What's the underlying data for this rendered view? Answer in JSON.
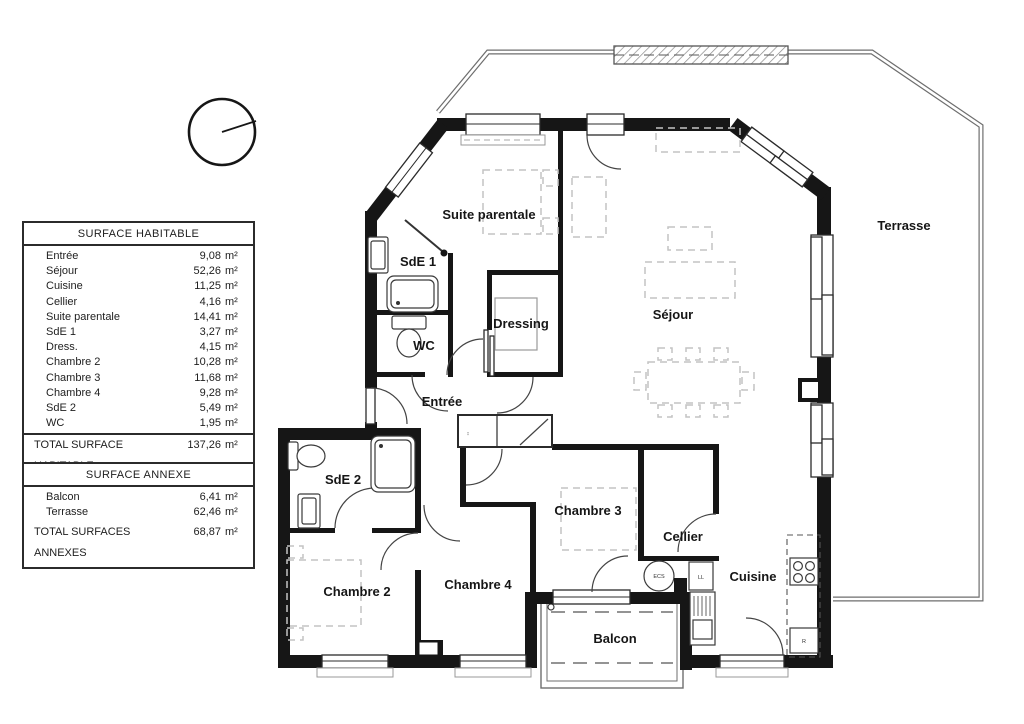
{
  "plan": {
    "rooms": {
      "suite_parentale": "Suite parentale",
      "sde1": "SdE 1",
      "wc": "WC",
      "dressing": "Dressing",
      "sejour": "Séjour",
      "entree": "Entrée",
      "sde2": "SdE 2",
      "chambre2": "Chambre 2",
      "chambre3": "Chambre 3",
      "chambre4": "Chambre 4",
      "cellier": "Cellier",
      "cuisine": "Cuisine",
      "balcon": "Balcon",
      "terrasse": "Terrasse"
    },
    "appliances": {
      "ecs": "ECS",
      "ll": "LL",
      "r": "R"
    }
  },
  "tables": {
    "habitable": {
      "title": "SURFACE HABITABLE",
      "rows": [
        {
          "label": "Entrée",
          "value": "9,08",
          "unit": "m²"
        },
        {
          "label": "Séjour",
          "value": "52,26",
          "unit": "m²"
        },
        {
          "label": "Cuisine",
          "value": "11,25",
          "unit": "m²"
        },
        {
          "label": "Cellier",
          "value": "4,16",
          "unit": "m²"
        },
        {
          "label": "Suite parentale",
          "value": "14,41",
          "unit": "m²"
        },
        {
          "label": "SdE 1",
          "value": "3,27",
          "unit": "m²"
        },
        {
          "label": "Dress.",
          "value": "4,15",
          "unit": "m²"
        },
        {
          "label": "Chambre 2",
          "value": "10,28",
          "unit": "m²"
        },
        {
          "label": "Chambre 3",
          "value": "11,68",
          "unit": "m²"
        },
        {
          "label": "Chambre 4",
          "value": "9,28",
          "unit": "m²"
        },
        {
          "label": "SdE 2",
          "value": "5,49",
          "unit": "m²"
        },
        {
          "label": "WC",
          "value": "1,95",
          "unit": "m²"
        }
      ],
      "total_label": "TOTAL SURFACE HABITABLE",
      "total_value": "137,26",
      "total_unit": "m²"
    },
    "annexe": {
      "title": "SURFACE ANNEXE",
      "rows": [
        {
          "label": "Balcon",
          "value": "6,41",
          "unit": "m²"
        },
        {
          "label": "Terrasse",
          "value": "62,46",
          "unit": "m²"
        }
      ],
      "total_label": "TOTAL SURFACES ANNEXES",
      "total_value": "68,87",
      "total_unit": "m²"
    }
  },
  "colors": {
    "wall": "#161616",
    "terrace_line": "#6e6e6e",
    "furniture": "#c3c3c3",
    "fixture": "#3a3a3a"
  }
}
